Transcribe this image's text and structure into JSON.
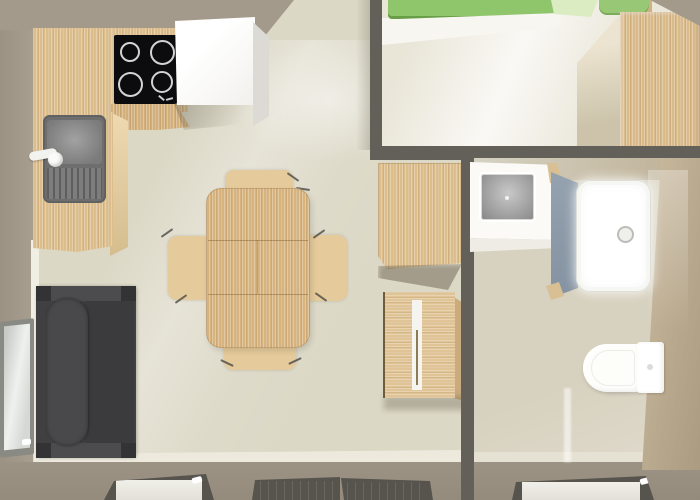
{
  "meta": {
    "type": "3d-floorplan-top-view",
    "description": "Top-down 3D rendering of a small one-bedroom mobile-home style apartment floor plan with open kitchen-living room, bedroom and bathroom"
  },
  "palette": {
    "wall_taupe": "#a39a8b",
    "wall_dark": "#63605a",
    "wall_tan": "#bfae93",
    "floor_living": "#dcd8c6",
    "floor_bedroom": "#e9e5d7",
    "floor_bath": "#d7d1bf",
    "wood": "#dcbd8c",
    "wood_table": "#d7b47f",
    "wood_chair": "#e5cb9b",
    "sofa": "#404042",
    "sofa_trim": "#4c4c4f",
    "cooktop": "#0c0c0e",
    "sink_gray": "#6f6f6f",
    "bed_green": "#8fc56b",
    "pillow_green": "#dcecc2",
    "cushion_green": "#98c876",
    "partition_blue": "#8c99a7",
    "fixture_white": "#fdfdfb",
    "glass": "#e9e7e1",
    "frame_gray": "#8a8a84"
  },
  "scene": {
    "rooms": [
      {
        "id": "living-kitchen",
        "name": "open living room with kitchen",
        "furniture": [
          "kitchen counter",
          "4-burner cooktop",
          "kitchen sink with drainboard and faucet",
          "white fridge/tall cabinet",
          "dining table with 4 wooden chairs",
          "dark gray sofa",
          "tall wooden cabinet",
          "wooden sideboard",
          "left wall window",
          "patio door panels"
        ]
      },
      {
        "id": "bedroom",
        "name": "bedroom (top right)",
        "furniture": [
          "double bed with green mattress and pillows",
          "large wooden wardrobe"
        ]
      },
      {
        "id": "bathroom",
        "name": "bathroom (right)",
        "furniture": [
          "white vanity with gray washbasin",
          "blue-gray shower partition",
          "white shower tray with drain",
          "wall-hung toilet with tank",
          "bottom window panel"
        ]
      }
    ]
  }
}
